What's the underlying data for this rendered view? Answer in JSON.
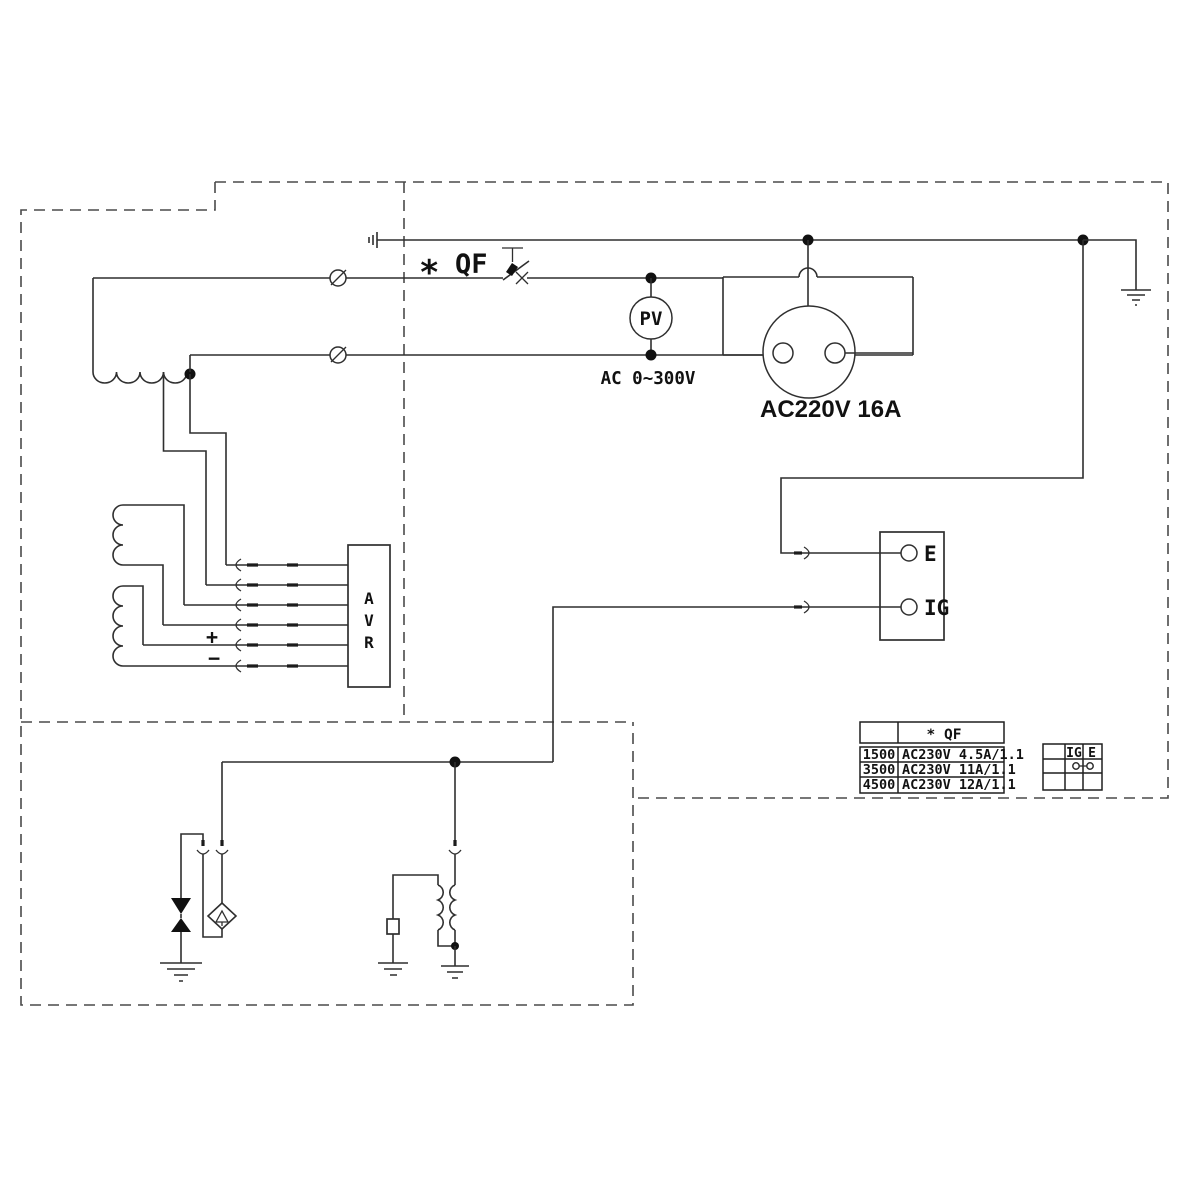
{
  "labels": {
    "breaker_marker": "*",
    "breaker": "QF",
    "voltmeter": "PV",
    "voltmeter_range": "AC 0~300V",
    "socket": "AC220V 16A",
    "avr_a": "A",
    "avr_v": "V",
    "avr_r": "R",
    "avr_plus": "+",
    "avr_minus": "−",
    "terminal_e": "E",
    "terminal_ig": "IG"
  },
  "qf_table": {
    "header": "* QF",
    "rows": [
      {
        "model": "1500",
        "spec": "AC230V 4.5A/1.1"
      },
      {
        "model": "3500",
        "spec": "AC230V 11A/1.1"
      },
      {
        "model": "4500",
        "spec": "AC230V 12A/1.1"
      }
    ]
  },
  "switch_table": {
    "col_ig": "IG",
    "col_e": "E"
  },
  "colors": {
    "line": "#2f2f2f",
    "text": "#111111",
    "background": "#ffffff"
  }
}
